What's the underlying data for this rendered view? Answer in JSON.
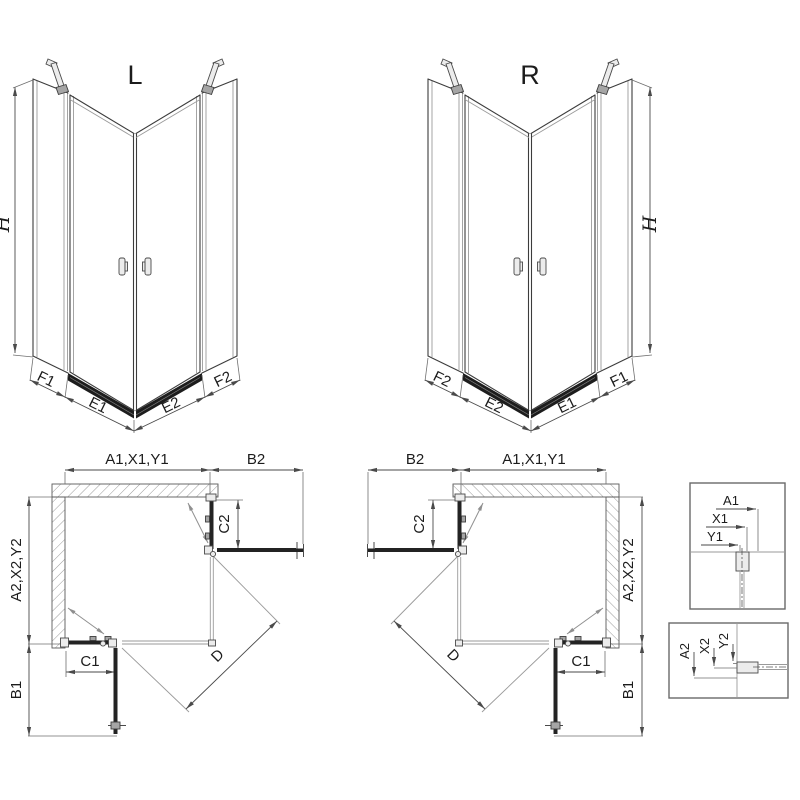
{
  "document": {
    "type": "shower-enclosure-technical-drawing",
    "colors": {
      "line": "#3c3c3c",
      "glass_line": "#9a9a9a",
      "profile_fill": "#232323",
      "dimension": "#4a4a4a",
      "background": "#ffffff"
    }
  },
  "views": {
    "iso_left": {
      "title": "L",
      "height": "H",
      "widths": [
        "F1",
        "E1",
        "E2",
        "F2"
      ]
    },
    "iso_right": {
      "title": "R",
      "height": "H",
      "widths": [
        "F2",
        "E2",
        "E1",
        "F1"
      ]
    },
    "plan_left": {
      "dims": {
        "a1": "A1,X1,Y1",
        "b2": "B2",
        "c2": "C2",
        "a2": "A2,X2,Y2",
        "c1": "C1",
        "b1": "B1",
        "d": "D"
      }
    },
    "plan_right": {
      "dims": {
        "a1": "A1,X1,Y1",
        "b2": "B2",
        "c2": "C2",
        "a2": "A2,X2,Y2",
        "c1": "C1",
        "b1": "B1",
        "d": "D"
      }
    },
    "detail_wall_profile": {
      "labels": {
        "a1": "A1",
        "x1": "X1",
        "y1": "Y1"
      }
    },
    "detail_floor_profile": {
      "labels": {
        "a2": "A2",
        "x2": "X2",
        "y2": "Y2"
      }
    }
  }
}
